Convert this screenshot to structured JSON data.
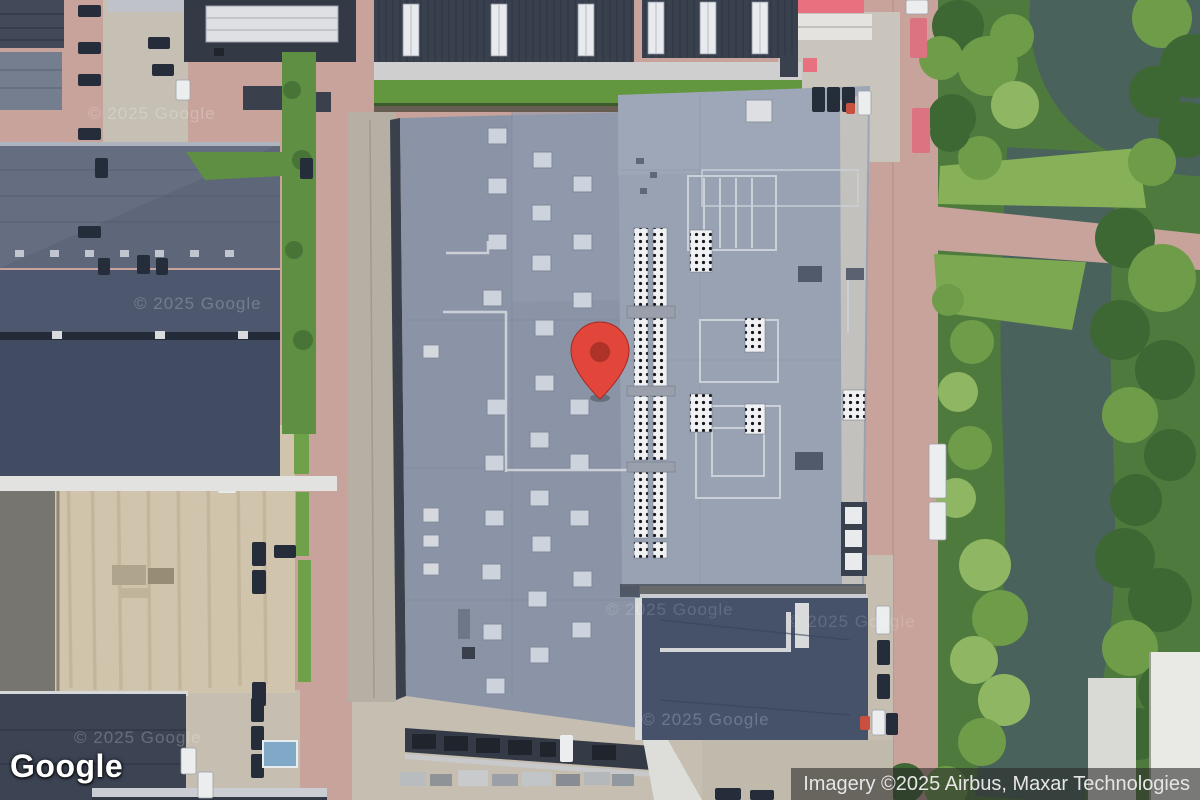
{
  "branding": {
    "logo_text": "Google"
  },
  "attribution": {
    "text": "Imagery ©2025 Airbus, Maxar Technologies"
  },
  "map": {
    "view_type": "satellite-imagery",
    "marker_icon": "red-map-pin",
    "watermark_text": "© 2025 Google"
  },
  "palette": {
    "marker": "#E2453A",
    "marker_inner": "#AD3227",
    "road": "#C8A39B",
    "concrete": "#C5BEB1",
    "sand": "#D0C4AC",
    "asphalt": "#77756F",
    "roof_main": "#8B94A6",
    "roof_main_light": "#99A2B3",
    "roof_dark": "#39404E",
    "roof_navy": "#46516A",
    "roof_slate": "#5D6779",
    "skylight": "#CDD3DD",
    "grass": "#6FA04A",
    "lawn": "#86B158",
    "tree_dark": "#3E6833",
    "tree_mid": "#6F9C49",
    "tree_light": "#8FB763",
    "water": "#4A625C",
    "red_roof": "#E8717F",
    "white_roof": "#E4E3DF",
    "attribution_bg": "rgba(40,40,40,0.58)",
    "attribution_fg": "#E6E6E6"
  }
}
